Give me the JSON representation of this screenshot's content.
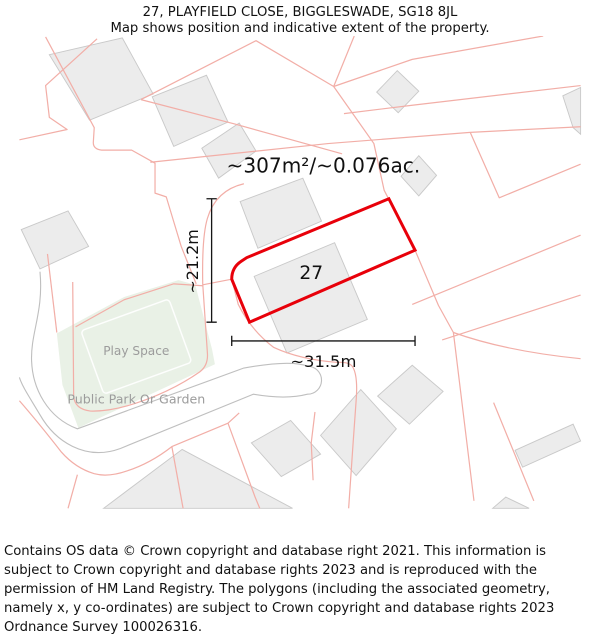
{
  "header": {
    "title": "27, PLAYFIELD CLOSE, BIGGLESWADE, SG18 8JL",
    "subtitle": "Map shows position and indicative extent of the property."
  },
  "map": {
    "area_label": "~307m²/~0.076ac.",
    "plot_number": "27",
    "dim_width_label": "~31.5m",
    "dim_height_label": "~21.2m",
    "play_space_label": "Play Space",
    "park_label": "Public Park Or Garden",
    "colors": {
      "plot-red": "#e8000a",
      "parcel-pink": "#f2aea7",
      "building-fill": "#ececec",
      "building-stroke": "#c9c9c9",
      "road-gray": "#bfbfbf",
      "park-green": "#e9f1e6",
      "label-gray": "#9c9c9c"
    }
  },
  "footer": {
    "text": "Contains OS data © Crown copyright and database right 2021. This information is subject to Crown copyright and database rights 2023 and is reproduced with the permission of HM Land Registry. The polygons (including the associated geometry, namely x, y co-ordinates) are subject to Crown copyright and database rights 2023 Ordnance Survey 100026316."
  }
}
